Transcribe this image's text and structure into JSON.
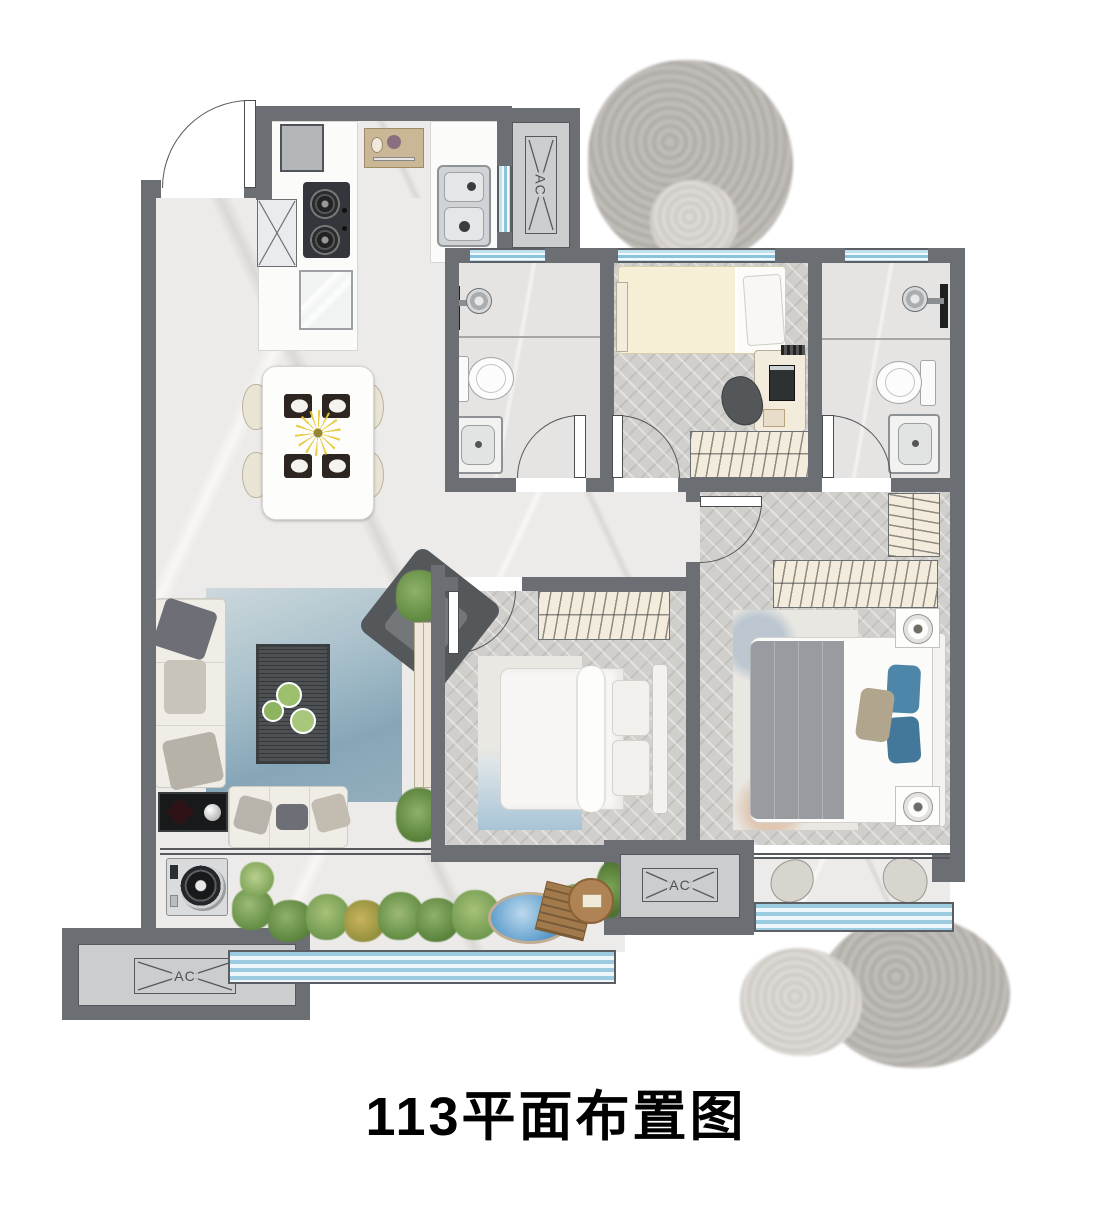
{
  "title": "113平面布置图",
  "ac_label": "AC",
  "palette": {
    "wall": "#6b6f74",
    "marble_floor": "#edebe9",
    "wood_floor": "#d1cfcc",
    "window": "#a9d3e8",
    "rug": "#8fb0c4",
    "accent_pillow": "#4d86a8",
    "plant": "#6d974c",
    "water": "#5e9ccb",
    "title_text": "#000000"
  }
}
